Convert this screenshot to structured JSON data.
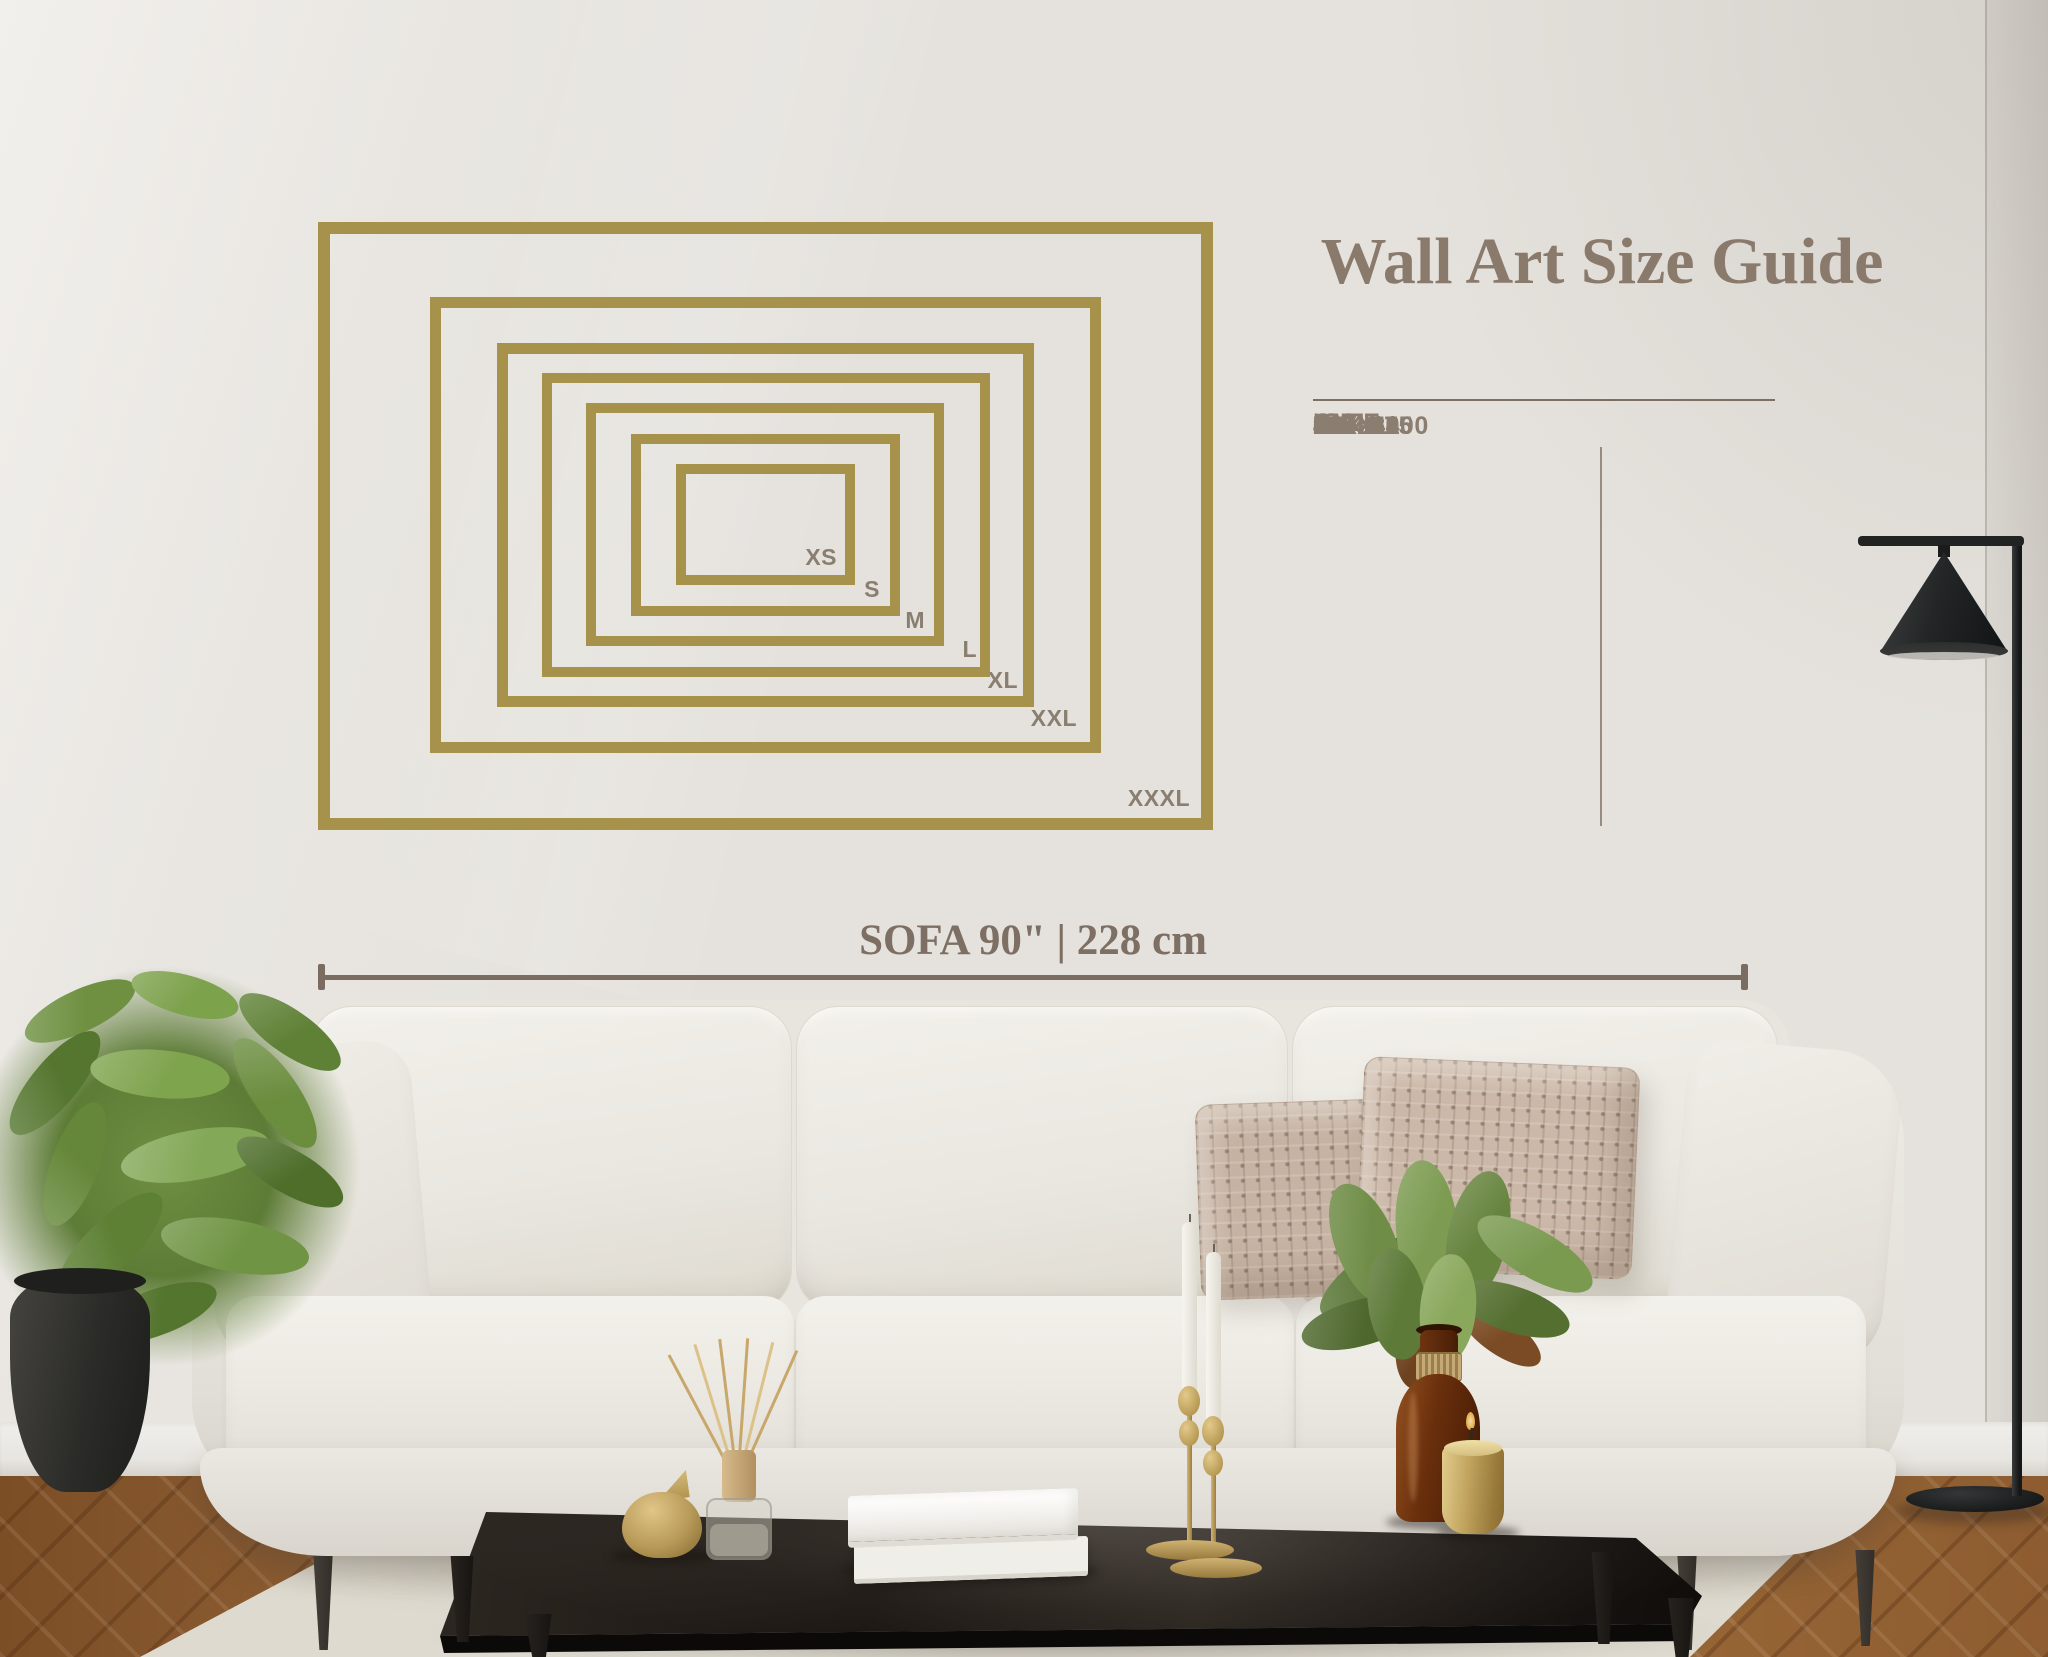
{
  "title": "Wall Art Size Guide",
  "table": {
    "headers": {
      "size": "SIZE",
      "inch": "INCH",
      "cm": "CM"
    }
  },
  "sizes": [
    {
      "label": "XS",
      "inch": "12 x 8",
      "cm": "30 x 20"
    },
    {
      "label": "S",
      "inch": "18 x 12",
      "cm": "46 x 30"
    },
    {
      "label": "M",
      "inch": "24 x 16",
      "cm": "60 x 40"
    },
    {
      "label": "L",
      "inch": "30 x 20",
      "cm": "76 x 51"
    },
    {
      "label": "XL",
      "inch": "36 x 24",
      "cm": "91 x 61"
    },
    {
      "label": "XXL",
      "inch": "45 x 30",
      "cm": "115 x 75"
    },
    {
      "label": "XXXL",
      "inch": "60 x 40",
      "cm": "150 x 100"
    }
  ],
  "sofa_measure": {
    "label": "SOFA 90\" | 228 cm"
  },
  "colors": {
    "frame_gold": "#a6924a",
    "label_text": "#8a7e70",
    "title_text": "#8a7a6c",
    "measure_line": "#7a6c61",
    "wall": "#e5e2dd"
  }
}
